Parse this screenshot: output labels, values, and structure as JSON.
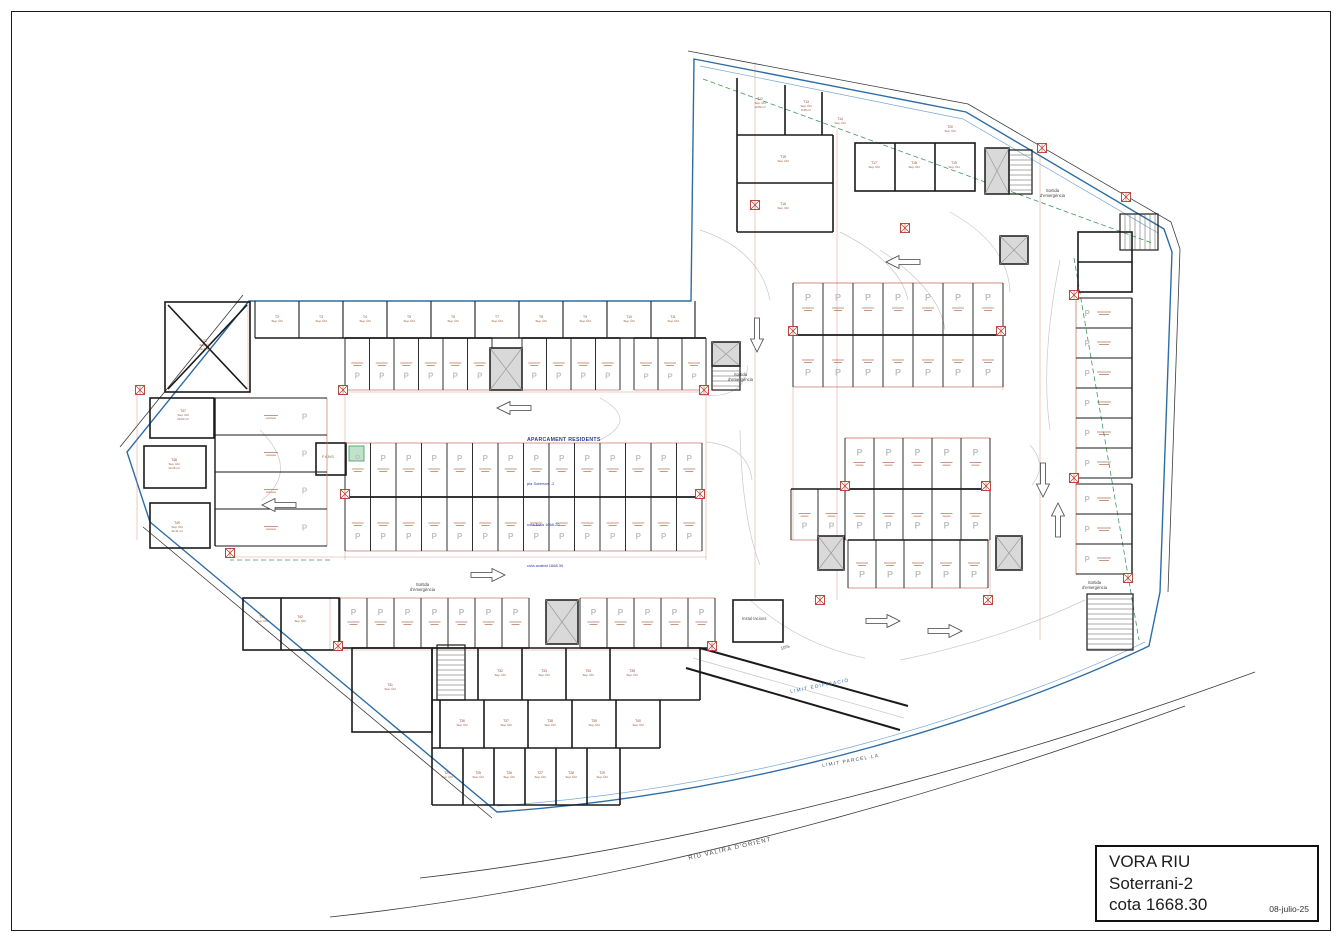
{
  "title_block": {
    "project": "VORA RIU",
    "level": "Soterrani-2",
    "elevation": "cota 1668.30",
    "date": "08-julio-25"
  },
  "plan_annotations": {
    "main_note": {
      "title": "APARCAMENT RESIDENTS",
      "lines": [
        "pla Soterrani -2",
        "cota llosa 1668.20",
        "cota acabat 1668.30"
      ]
    },
    "emergency_exit_line1": "Sortida",
    "emergency_exit_line2": "d'emergència",
    "ramp_slope_label": "10%",
    "installations_room_label": "Instal·lacions",
    "fans_room_label": "FANS",
    "site_labels": [
      {
        "label": "RIU VALIRA D'ORIENT"
      },
      {
        "label": "LIMIT PARCEL·LA"
      },
      {
        "label": "LIMIT EDIFICACIÓ"
      }
    ]
  },
  "stall_marker": "P",
  "room_sublabel": "Sup. Útil",
  "colors": {
    "wall": "#1a1a1a",
    "boundary": "#2e6da4",
    "boundary_light": "#7aa7d9",
    "parcel": "#3a3a3a",
    "dim": "#cc7766",
    "stall_text": "#a0522d",
    "hatch": "#b03a2e",
    "p_marker": "#c2c2c2",
    "green": "#3c9a5f",
    "green_fill": "#bfe3c8",
    "lane": "#c9c9c9",
    "label": "#8b4a2f",
    "core_fill": "#d9d9d9"
  },
  "plan": {
    "geometry": {
      "building_outline": "M 694,59 L 966,112 L 1164,229 L 1172,252 L 1160,592 L 1149,646 C 1010,712 770,793 497,812 L 150,522 L 127,452 L 249,301 L 691,301 Z",
      "building_inner_line": "M 700,66 L 963,119 L 1158,233",
      "building_inner_bottom": "M 497,806 C 770,787 1010,707 1145,642",
      "parcel_lines": [
        "M 688,51 L 968,104 L 1171,222 L 1180,249 L 1168,592",
        "M 120,447 L 243,295",
        "M 143,527 L 492,818",
        "M 420,878 C 700,846 1010,762 1255,672",
        "M 330,917 C 640,884 950,792 1185,706"
      ],
      "green_dashed": [
        "M 1074,258 L 1139,640",
        "M 703,79 L 1152,243",
        "M 330,560 L 230,560"
      ],
      "ramp_walls": [
        "M 700,648 L 908,706",
        "M 686,668 L 900,730"
      ],
      "ramp_lanes": [
        "M 693,658 L 904,718"
      ],
      "aisle_curves": [
        "M 700,230 Q 760,250 770,300",
        "M 840,232 Q 900,262 908,300",
        "M 950,212 Q 1008,244 1010,292",
        "M 1060,260 Q 1040,360 1050,430",
        "M 700,395 Q 745,400 748,365",
        "M 706,442 Q 748,446 752,480",
        "M 600,398 Q 640,420 600,440",
        "M 1030,445 Q 1048,465 1032,485",
        "M 750,600 Q 800,645 865,658",
        "M 900,660 Q 1000,640 1085,600",
        "M 260,430 Q 300,470 262,500",
        "M 880,250 Q 940,290 945,330",
        "M 740,430 Q 742,520 760,565"
      ]
    },
    "walls": {
      "strip": {
        "x0": 255,
        "step": 44,
        "n": 11,
        "y1": 301,
        "y2": 338
      },
      "lines": [
        [
          255,
          338,
          706,
          338
        ],
        [
          737,
          78,
          737,
          232
        ],
        [
          737,
          135,
          833,
          135
        ],
        [
          737,
          183,
          833,
          183
        ],
        [
          737,
          232,
          833,
          232
        ],
        [
          833,
          135,
          833,
          232
        ],
        [
          785,
          85,
          785,
          135
        ],
        [
          822,
          92,
          822,
          135
        ],
        [
          895,
          143,
          895,
          191
        ],
        [
          935,
          143,
          935,
          191
        ],
        [
          432,
          648,
          700,
          648
        ],
        [
          432,
          648,
          432,
          805
        ],
        [
          432,
          805,
          620,
          805
        ],
        [
          620,
          805,
          620,
          748
        ],
        [
          620,
          748,
          660,
          748
        ],
        [
          660,
          748,
          660,
          700
        ],
        [
          660,
          700,
          700,
          700
        ],
        [
          700,
          700,
          700,
          648
        ],
        [
          432,
          700,
          660,
          700
        ],
        [
          432,
          748,
          620,
          748
        ],
        [
          478,
          648,
          478,
          700
        ],
        [
          522,
          648,
          522,
          700
        ],
        [
          566,
          648,
          566,
          700
        ],
        [
          610,
          648,
          610,
          700
        ],
        [
          440,
          700,
          440,
          748
        ],
        [
          484,
          700,
          484,
          748
        ],
        [
          528,
          700,
          528,
          748
        ],
        [
          572,
          700,
          572,
          748
        ],
        [
          616,
          700,
          616,
          748
        ],
        [
          463,
          748,
          463,
          805
        ],
        [
          494,
          748,
          494,
          805
        ],
        [
          525,
          748,
          525,
          805
        ],
        [
          556,
          748,
          556,
          805
        ],
        [
          587,
          748,
          587,
          805
        ],
        [
          281,
          598,
          281,
          650
        ],
        [
          1078,
          262,
          1132,
          262
        ],
        [
          168,
          305,
          247,
          389
        ],
        [
          247,
          305,
          168,
          389
        ]
      ],
      "rects": [
        [
          855,
          143,
          120,
          48
        ],
        [
          352,
          648,
          80,
          84
        ],
        [
          243,
          598,
          96,
          52
        ],
        [
          733,
          600,
          50,
          42
        ],
        [
          316,
          443,
          30,
          32
        ],
        [
          165,
          302,
          85,
          90
        ],
        [
          150,
          398,
          64,
          40
        ],
        [
          144,
          446,
          62,
          42
        ],
        [
          150,
          503,
          60,
          45
        ],
        [
          1078,
          232,
          54,
          60
        ]
      ]
    },
    "green_boxes": [
      [
        349,
        446,
        15,
        15
      ],
      [
        1006,
        246,
        12,
        12
      ]
    ],
    "parking_rows": [
      {
        "x": 793,
        "y": 283,
        "w": 30,
        "h": 52,
        "n": 7,
        "open": "up"
      },
      {
        "x": 793,
        "y": 335,
        "w": 30,
        "h": 52,
        "n": 7,
        "open": "down"
      },
      {
        "x": 845,
        "y": 438,
        "w": 29,
        "h": 51,
        "n": 5,
        "open": "up"
      },
      {
        "x": 845,
        "y": 489,
        "w": 29,
        "h": 51,
        "n": 5,
        "open": "down"
      },
      {
        "x": 791,
        "y": 489,
        "w": 27,
        "h": 51,
        "n": 2,
        "open": "down"
      },
      {
        "x": 345,
        "y": 338,
        "w": 24.5,
        "h": 52,
        "n": 6,
        "open": "down"
      },
      {
        "x": 522,
        "y": 338,
        "w": 24.5,
        "h": 52,
        "n": 4,
        "open": "down"
      },
      {
        "x": 634,
        "y": 338,
        "w": 24,
        "h": 52,
        "n": 3,
        "open": "down"
      },
      {
        "x": 345,
        "y": 443,
        "w": 25.5,
        "h": 54,
        "n": 14,
        "open": "up"
      },
      {
        "x": 345,
        "y": 497,
        "w": 25.5,
        "h": 54,
        "n": 14,
        "open": "down"
      },
      {
        "x": 340,
        "y": 598,
        "w": 27,
        "h": 50,
        "n": 7,
        "open": "up"
      },
      {
        "x": 580,
        "y": 598,
        "w": 27,
        "h": 50,
        "n": 5,
        "open": "up"
      },
      {
        "x": 848,
        "y": 540,
        "w": 28,
        "h": 48,
        "n": 5,
        "open": "down"
      },
      {
        "x": 1076,
        "y": 298,
        "w": 56,
        "h": 30,
        "n": 6,
        "open": "left",
        "horiz": true
      },
      {
        "x": 1076,
        "y": 484,
        "w": 56,
        "h": 30,
        "n": 3,
        "open": "left",
        "horiz": true
      },
      {
        "x": 215,
        "y": 398,
        "w": 112,
        "h": 37,
        "n": 4,
        "open": "right",
        "horiz": true
      }
    ],
    "cores": [
      [
        490,
        348,
        32,
        42
      ],
      [
        546,
        600,
        32,
        44
      ],
      [
        818,
        536,
        26,
        34
      ],
      [
        996,
        536,
        26,
        34
      ],
      [
        1000,
        236,
        28,
        28
      ],
      [
        985,
        148,
        24,
        46
      ],
      [
        712,
        342,
        28,
        24
      ]
    ],
    "stairs": [
      {
        "x": 437,
        "y": 645,
        "w": 28,
        "h": 55,
        "dir": "h"
      },
      {
        "x": 1087,
        "y": 594,
        "w": 46,
        "h": 56,
        "dir": "h"
      },
      {
        "x": 1120,
        "y": 214,
        "w": 38,
        "h": 36,
        "dir": "v"
      },
      {
        "x": 1009,
        "y": 150,
        "w": 23,
        "h": 44,
        "dir": "h"
      },
      {
        "x": 712,
        "y": 366,
        "w": 28,
        "h": 24,
        "dir": "h"
      }
    ],
    "columns": [
      [
        1042,
        148
      ],
      [
        1126,
        197
      ],
      [
        905,
        228
      ],
      [
        755,
        205
      ],
      [
        793,
        331
      ],
      [
        1001,
        331
      ],
      [
        845,
        486
      ],
      [
        986,
        486
      ],
      [
        345,
        494
      ],
      [
        700,
        494
      ],
      [
        343,
        390
      ],
      [
        704,
        390
      ],
      [
        338,
        646
      ],
      [
        712,
        646
      ],
      [
        230,
        553
      ],
      [
        140,
        390
      ],
      [
        1074,
        295
      ],
      [
        1074,
        478
      ],
      [
        1128,
        578
      ],
      [
        820,
        600
      ],
      [
        988,
        600
      ]
    ],
    "dims": [
      [
        793,
        335,
        1003,
        335
      ],
      [
        345,
        497,
        702,
        497
      ],
      [
        845,
        489,
        990,
        489
      ],
      [
        340,
        392,
        706,
        392
      ],
      [
        230,
        557,
        706,
        557
      ],
      [
        330,
        650,
        715,
        650
      ],
      [
        793,
        283,
        1003,
        283
      ],
      [
        845,
        438,
        990,
        438
      ],
      [
        755,
        62,
        755,
        598
      ],
      [
        837,
        130,
        837,
        600
      ],
      [
        1040,
        150,
        1040,
        640
      ],
      [
        345,
        340,
        345,
        560
      ],
      [
        706,
        340,
        706,
        560
      ],
      [
        137,
        390,
        137,
        540
      ],
      [
        248,
        303,
        248,
        392
      ],
      [
        793,
        283,
        793,
        540
      ],
      [
        1003,
        283,
        1003,
        390
      ],
      [
        990,
        438,
        990,
        600
      ],
      [
        1076,
        298,
        1076,
        575
      ],
      [
        330,
        598,
        330,
        650
      ]
    ],
    "arrows": [
      {
        "x": 886,
        "y": 262,
        "r": 0
      },
      {
        "x": 497,
        "y": 408,
        "r": 0
      },
      {
        "x": 262,
        "y": 505,
        "r": 0
      },
      {
        "x": 505,
        "y": 575,
        "r": 180
      },
      {
        "x": 900,
        "y": 621,
        "r": 180
      },
      {
        "x": 962,
        "y": 631,
        "r": 180
      },
      {
        "x": 1043,
        "y": 497,
        "r": -90
      },
      {
        "x": 1058,
        "y": 503,
        "r": 90
      },
      {
        "x": 757,
        "y": 352,
        "r": -90
      }
    ],
    "rooms": [
      {
        "id": "T1",
        "area": "23.44 m²",
        "x": 205,
        "y": 342
      },
      {
        "id": "T2",
        "area": "",
        "x": 277,
        "y": 318
      },
      {
        "id": "T3",
        "area": "",
        "x": 321,
        "y": 318
      },
      {
        "id": "T4",
        "area": "",
        "x": 365,
        "y": 318
      },
      {
        "id": "T5",
        "area": "",
        "x": 409,
        "y": 318
      },
      {
        "id": "T6",
        "area": "",
        "x": 453,
        "y": 318
      },
      {
        "id": "T7",
        "area": "",
        "x": 497,
        "y": 318
      },
      {
        "id": "T8",
        "area": "",
        "x": 541,
        "y": 318
      },
      {
        "id": "T9",
        "area": "",
        "x": 585,
        "y": 318
      },
      {
        "id": "T10",
        "area": "",
        "x": 629,
        "y": 318
      },
      {
        "id": "T11",
        "area": "",
        "x": 673,
        "y": 318
      },
      {
        "id": "T12",
        "area": "12.84 m²",
        "x": 760,
        "y": 100
      },
      {
        "id": "T13",
        "area": "8.45 m²",
        "x": 806,
        "y": 103
      },
      {
        "id": "T14",
        "area": "",
        "x": 840,
        "y": 120
      },
      {
        "id": "T15",
        "area": "",
        "x": 783,
        "y": 158
      },
      {
        "id": "T16",
        "area": "",
        "x": 783,
        "y": 205
      },
      {
        "id": "T17",
        "area": "",
        "x": 874,
        "y": 164
      },
      {
        "id": "T18",
        "area": "",
        "x": 914,
        "y": 164
      },
      {
        "id": "T19",
        "area": "",
        "x": 954,
        "y": 164
      },
      {
        "id": "T20",
        "area": "",
        "x": 950,
        "y": 128
      },
      {
        "id": "T41",
        "area": "",
        "x": 262,
        "y": 618
      },
      {
        "id": "T42",
        "area": "",
        "x": 300,
        "y": 618
      },
      {
        "id": "T31",
        "area": "",
        "x": 390,
        "y": 686
      },
      {
        "id": "T32",
        "area": "",
        "x": 500,
        "y": 672
      },
      {
        "id": "T33",
        "area": "",
        "x": 544,
        "y": 672
      },
      {
        "id": "T34",
        "area": "",
        "x": 588,
        "y": 672
      },
      {
        "id": "T35",
        "area": "",
        "x": 632,
        "y": 672
      },
      {
        "id": "T36",
        "area": "",
        "x": 462,
        "y": 722
      },
      {
        "id": "T37",
        "area": "",
        "x": 506,
        "y": 722
      },
      {
        "id": "T38",
        "area": "",
        "x": 550,
        "y": 722
      },
      {
        "id": "T39",
        "area": "",
        "x": 594,
        "y": 722
      },
      {
        "id": "T40",
        "area": "",
        "x": 638,
        "y": 722
      },
      {
        "id": "T24",
        "area": "",
        "x": 447,
        "y": 774
      },
      {
        "id": "T25",
        "area": "",
        "x": 478,
        "y": 774
      },
      {
        "id": "T26",
        "area": "",
        "x": 509,
        "y": 774
      },
      {
        "id": "T27",
        "area": "",
        "x": 540,
        "y": 774
      },
      {
        "id": "T28",
        "area": "",
        "x": 571,
        "y": 774
      },
      {
        "id": "T29",
        "area": "",
        "x": 602,
        "y": 774
      },
      {
        "id": "T47",
        "area": "20.04 m²",
        "x": 183,
        "y": 412
      },
      {
        "id": "T48",
        "area": "13.26 m²",
        "x": 174,
        "y": 461
      },
      {
        "id": "T49",
        "area": "12.41 m²",
        "x": 177,
        "y": 524
      }
    ]
  }
}
